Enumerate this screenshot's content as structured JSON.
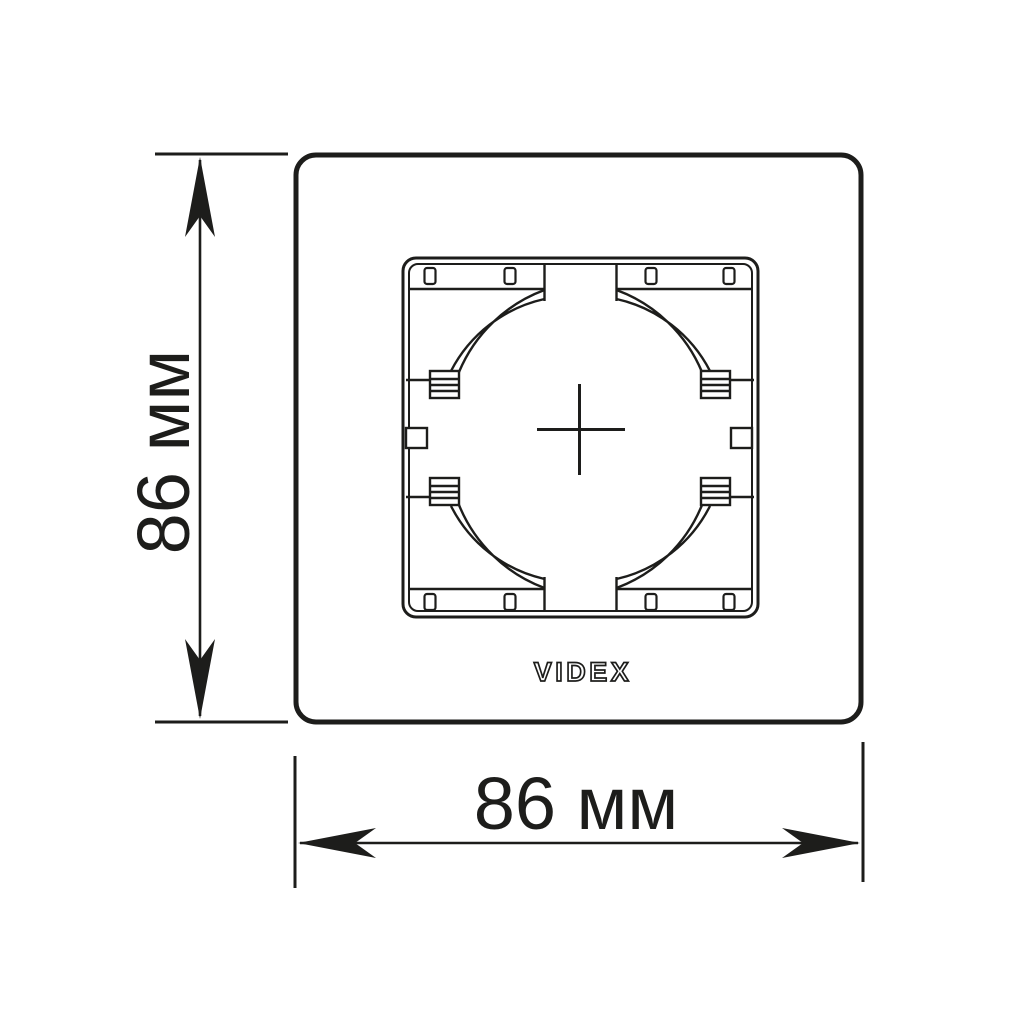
{
  "drawing": {
    "type": "technical-dimension-drawing",
    "subject": "single wall switch/socket faceplate frame, front view",
    "brand": "VIDEX",
    "dimensions": {
      "height": {
        "value": 86,
        "unit": "мм",
        "label": "86 мм"
      },
      "width": {
        "value": 86,
        "unit": "мм",
        "label": "86 мм"
      }
    },
    "colors": {
      "line": "#1d1d1b",
      "background": "#ffffff"
    }
  }
}
